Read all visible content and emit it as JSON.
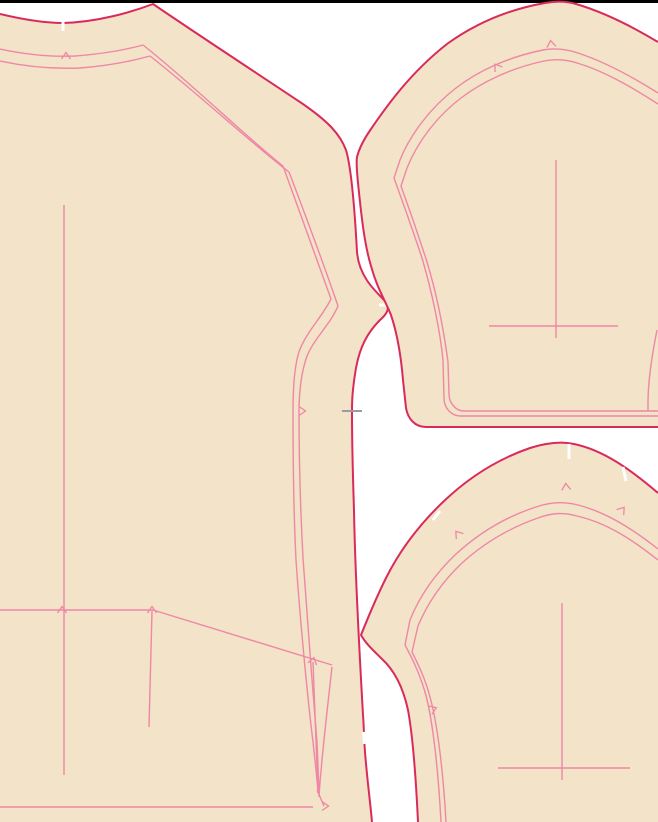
{
  "canvas": {
    "width": 658,
    "height": 822,
    "background": "#ffffff",
    "top_bar_color": "#000000",
    "top_bar_height": 3
  },
  "colors": {
    "fabric_fill": "#f2e3c9",
    "cut_line": "#d92b5b",
    "seam_line": "#ef87a5",
    "notch_white": "#ffffff",
    "match_mark_gray": "#9c9c9c"
  },
  "pieces": [
    {
      "name": "bodice-piece",
      "fill_path": "M 0 14 C 25 20 48 23 63 23 C 98 22 132 12 153 4 C 200 36 258 74 300 102 C 328 121 340 134 346 150 C 352 170 355 215 357 252 C 359 276 374 290 386 302 C 390 307 388 313 380 320 C 368 332 360 346 356 368 C 352 392 352 402 352 412 C 352 445 353 480 354 510 C 355 570 359 645 363 715 C 364 728 364 740 365 752 C 367 778 370 800 372 822 L 0 822 Z",
      "outline_path": "M 0 14 C 25 20 48 23 63 23 C 98 22 132 12 153 4 C 200 36 258 74 300 102 C 328 121 340 134 346 150 C 352 170 355 215 357 252 C 359 276 374 290 386 302 C 390 307 388 313 380 320 C 368 332 360 346 356 368 C 352 392 352 402 352 412 C 352 445 353 480 354 510 C 355 570 359 645 363 715 C 364 728 364 740 365 752 C 367 778 370 800 372 822",
      "inner_lines": [
        "M 0 49 C 28 55 52 57 75 56 C 100 54 125 50 143 45",
        "M 0 61 C 28 67 55 69 80 68 C 106 66 132 61 150 56",
        "M 143 45 C 190 82 245 136 283 166",
        "M 150 56 C 196 92 250 142 289 172",
        "M 283 166 C 298 208 318 262 331 299",
        "M 289 172 C 305 214 325 268 338 306",
        "M 331 299 C 322 317 308 330 300 349 C 295 362 293 385 293 412 C 293 465 294 520 296 560 C 299 604 306 685 313 742 C 315 760 317 778 318 792",
        "M 338 306 C 330 325 315 337 307 356 C 302 370 299 390 299 413 C 299 462 301 520 303 558 C 306 602 312 682 317 742 L 319 790",
        "M 313 662 L 318 793",
        "M 332 667 C 327 712 321 762 319 797",
        "M 317 790 L 324 806",
        "M 0 610 L 153 610",
        "M 153 610 L 332 665",
        "M 152 611 L 149 727",
        "M 0 807 L 313 807"
      ],
      "grain_lines": [
        "M 64 205 L 64 775"
      ],
      "white_notches": [
        "M 63 16 L 63 31",
        "M 379 305 L 393 305",
        "M 363.5 732 L 364.5 744"
      ],
      "gray_marks": [
        "M 342 411 L 362 411"
      ],
      "triangle_notches": [
        {
          "x": 66,
          "y": 56,
          "angle": 0
        },
        {
          "x": 62,
          "y": 610,
          "angle": 0
        },
        {
          "x": 152,
          "y": 610,
          "angle": 0
        },
        {
          "x": 302,
          "y": 411,
          "angle": 90
        },
        {
          "x": 313,
          "y": 661,
          "angle": 15
        },
        {
          "x": 325,
          "y": 806,
          "angle": 90
        }
      ]
    },
    {
      "name": "upper-sleeve-piece",
      "fill_path": "M 658 42 C 628 24 600 11 576 4 C 566 1 556 1 545 3 C 505 10 472 26 447 44 C 410 73 386 107 371 129 C 364 139 359 149 357 157 C 356 163 357 172 358 183 C 361 212 364 243 371 266 C 377 288 385 300 391 315 C 397 333 401 356 403 380 L 406 408 C 408 419 415 427 426 427 L 658 427 Z",
      "outline_path": "M 658 42 C 628 24 600 11 576 4 C 566 1 556 1 545 3 C 505 10 472 26 447 44 C 410 73 386 107 371 129 C 364 139 359 149 357 157 C 356 163 357 172 358 183 C 361 212 364 243 371 266 C 377 288 385 300 391 315 C 397 333 401 356 403 380 L 406 408 C 408 419 415 427 426 427 L 658 427",
      "inner_lines": [
        "M 658 93 C 628 74 602 61 578 53 C 566 49 554 48 543 50 C 508 57 478 71 456 88 C 430 108 410 135 400 160 L 394 178 C 402 200 412 228 422 258 C 432 292 440 330 443 360 L 444 398 C 444 408 451 416 461 416 L 658 416",
        "M 658 104 C 627 84 601 70 577 63 C 565 59 554 59 544 61 C 511 68 482 82 461 98 C 436 117 417 143 407 168 L 401 186 C 409 208 418 234 427 262 C 437 295 444 332 448 362 L 449 394 C 449 402 455 411 464 411 L 658 411",
        "M 657 330 C 651 360 648 385 648 403 L 648 411"
      ],
      "grain_lines": [
        "M 556 160 L 556 338",
        "M 489 326 L 618 326"
      ],
      "white_notches": [],
      "gray_marks": [],
      "triangle_notches": [
        {
          "x": 497,
          "y": 67,
          "angle": -35
        },
        {
          "x": 551,
          "y": 44,
          "angle": -8
        }
      ]
    },
    {
      "name": "lower-sleeve-piece",
      "fill_path": "M 658 493 C 630 469 603 450 574 444 C 560 441 546 443 530 448 C 498 459 468 478 443 502 C 420 524 400 550 386 578 C 376 598 367 620 361 635 C 366 644 374 651 382 659 C 394 670 403 687 408 710 C 413 737 416 780 418 822 L 658 822 Z",
      "outline_path": "M 658 493 C 630 469 603 450 574 444 C 560 441 546 443 530 448 C 498 459 468 478 443 502 C 420 524 400 550 386 578 C 376 598 367 620 361 635 C 366 644 374 651 382 659 C 394 670 403 687 408 710 C 413 737 416 780 418 822",
      "inner_lines": [
        "M 658 549 C 630 527 605 512 578 505 C 563 501 550 502 536 507 C 505 517 478 534 456 554 C 436 573 420 595 410 620 L 405 645 C 412 658 419 672 425 692 C 432 716 438 765 441 822",
        "M 658 560 C 629 537 604 522 577 516 C 563 512 551 513 538 518 C 509 528 483 544 462 563 C 443 581 428 602 418 626 L 412 652 C 418 664 425 678 430 697 C 437 722 443 768 446 822"
      ],
      "grain_lines": [
        "M 562 603 L 562 780",
        "M 498 768 L 630 768"
      ],
      "white_notches": [
        "M 569 444 L 569 459",
        "M 623 467 L 626 481",
        "M 433 520 L 440 511"
      ],
      "gray_marks": [],
      "triangle_notches": [
        {
          "x": 566,
          "y": 487,
          "angle": -5
        },
        {
          "x": 622,
          "y": 510,
          "angle": 38
        },
        {
          "x": 458,
          "y": 534,
          "angle": -38
        },
        {
          "x": 433,
          "y": 709,
          "angle": 68
        }
      ]
    }
  ]
}
